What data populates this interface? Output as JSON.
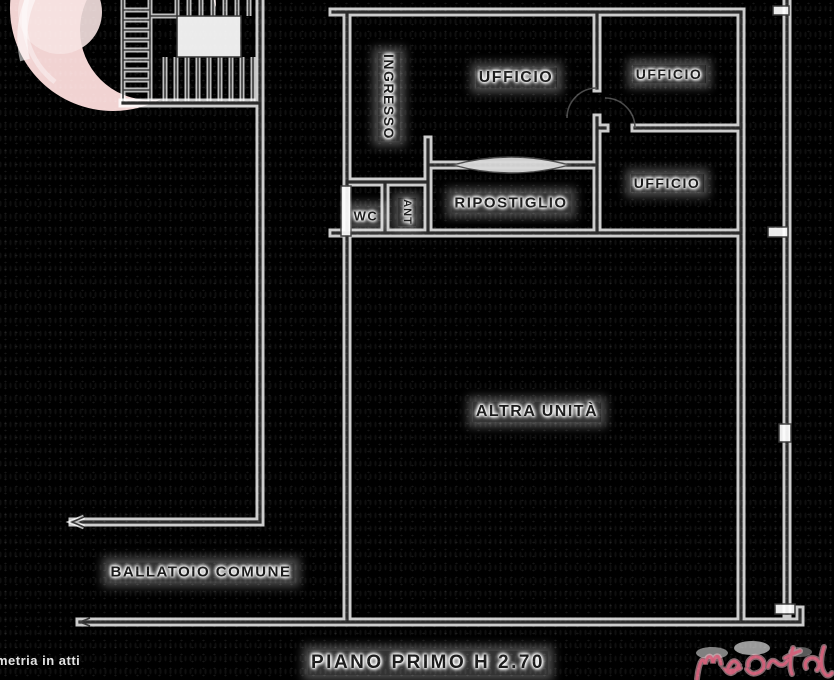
{
  "plan": {
    "rooms": {
      "ingresso": "INGRESSO",
      "ufficio_center": "UFFICIO",
      "ufficio_top_right": "UFFICIO",
      "ufficio_bottom_right": "UFFICIO",
      "ripostiglio": "RIPOSTIGLIO",
      "wc": "WC",
      "anti": "ANT",
      "altra_unita": "ALTRA UNITÀ"
    },
    "common_area_label": "BALLATOIO COMUNE",
    "floor_caption": "PIANO PRIMO H 2.70"
  },
  "watermarks": {
    "bottom_left_text": "metria in atti",
    "top_left_icon": "pink-circle-watermark",
    "bottom_right_icon": "pink-script-logo"
  },
  "colors": {
    "background": "#000000",
    "ink": "#2b2b2b",
    "halo": "#ffffff",
    "watermark_pink": "#f1d3d2",
    "logo_pink": "#d4607a"
  }
}
